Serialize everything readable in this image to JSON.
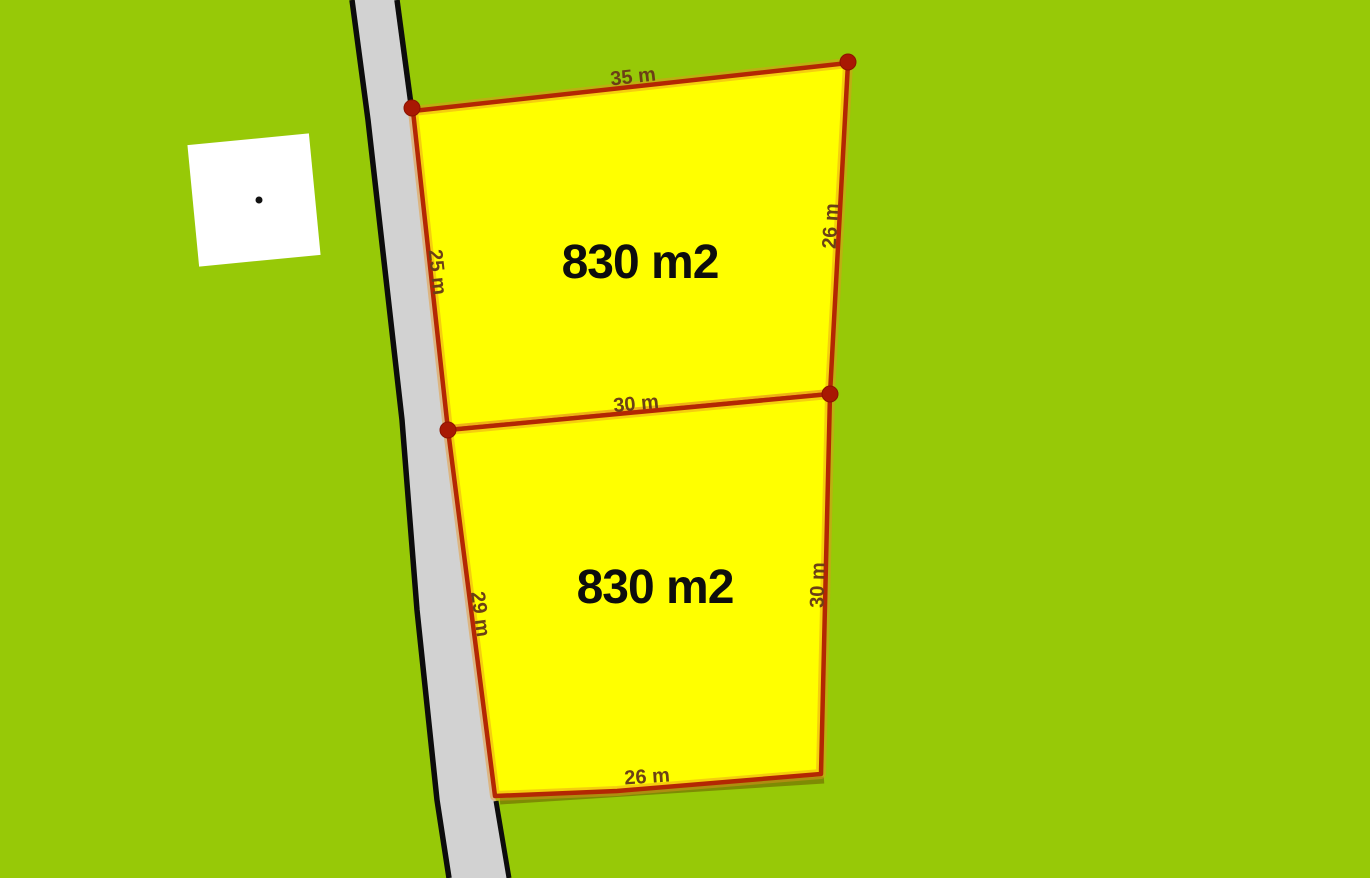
{
  "scene": {
    "type": "land-parcel-map",
    "colors": {
      "background": "#97C907",
      "road_fill": "#D2D2D2",
      "road_border": "#0C0C0C",
      "plot_fill": "#FFFF00",
      "plot_outline": "#B32703",
      "plot_glow": "#E8921E",
      "corner_dot": "#A81803",
      "dimension_label": "#6B4016",
      "area_label": "#0D0D0D",
      "building_fill": "#FFFFFF",
      "building_dot": "#111111"
    }
  },
  "plots": [
    {
      "area_label": "830 m2",
      "dimensions": {
        "top": "35 m",
        "left": "25 m",
        "right": "26 m",
        "bottom": "30 m"
      }
    },
    {
      "area_label": "830 m2",
      "dimensions": {
        "left": "29 m",
        "right": "30 m",
        "bottom": "26 m"
      }
    }
  ]
}
